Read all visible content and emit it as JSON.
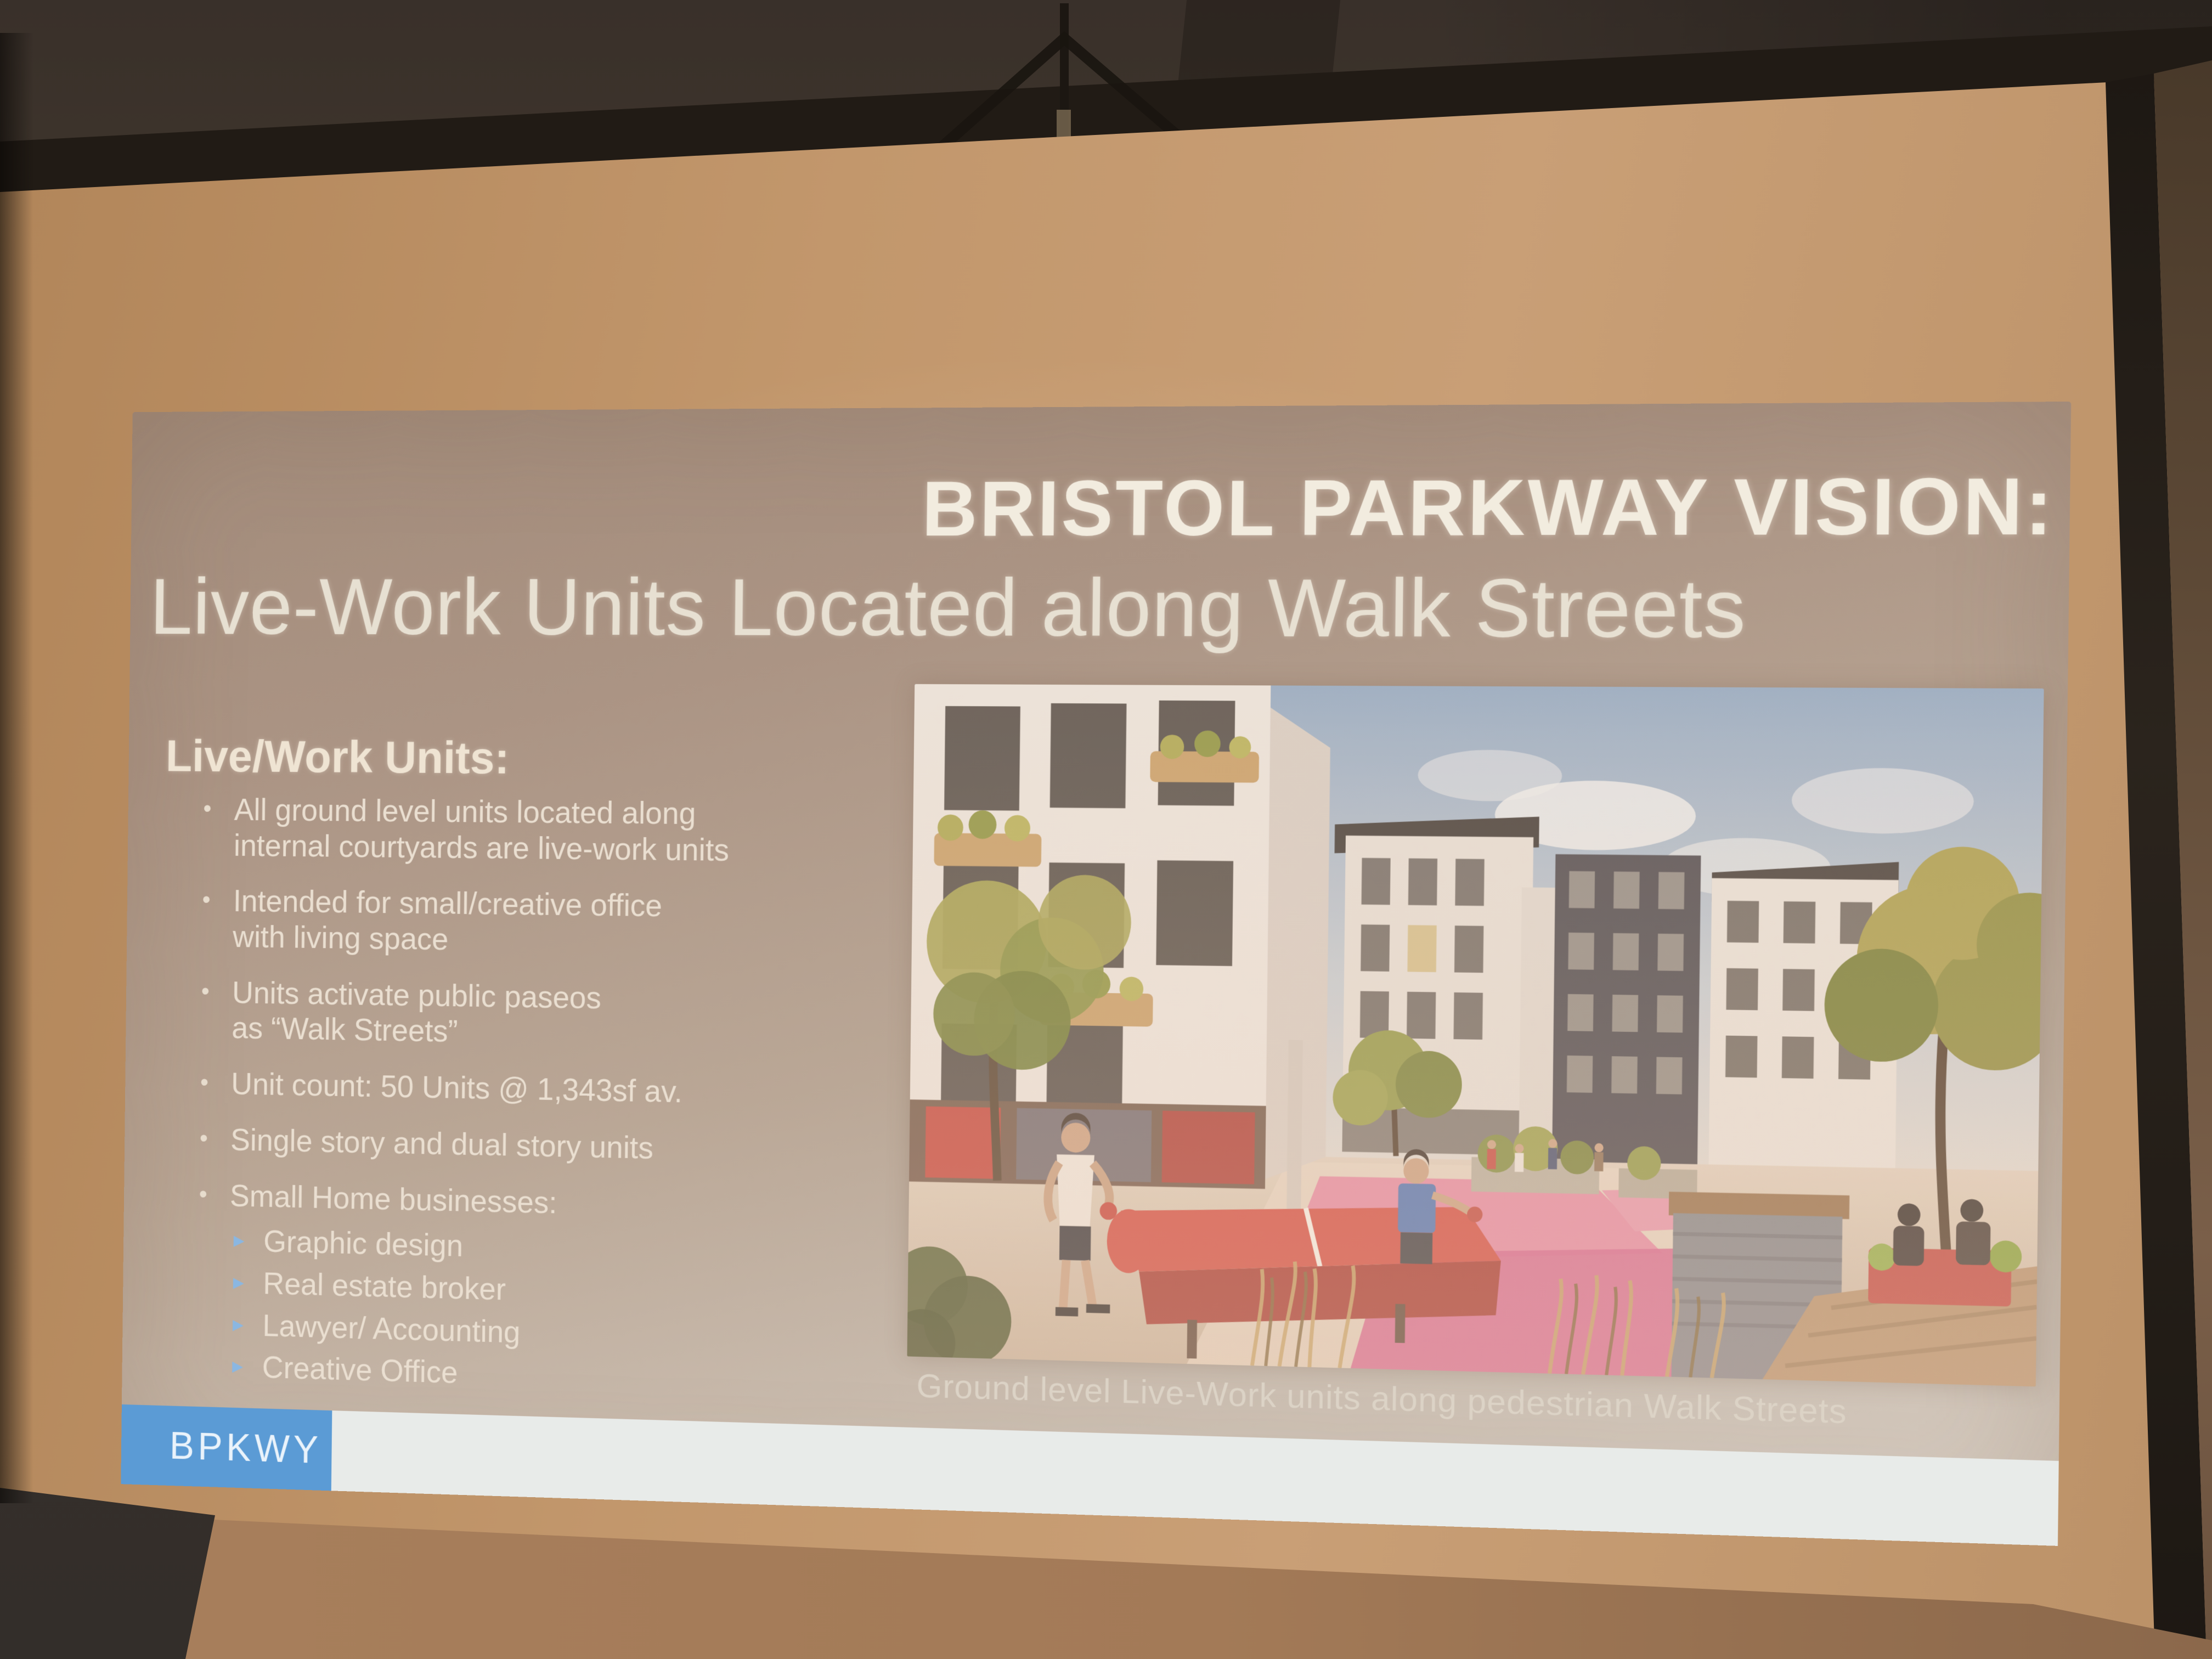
{
  "slide": {
    "title_line1": "BRISTOL PARKWAY VISION:",
    "title_line2": "Live-Work Units Located along Walk Streets",
    "left_column": {
      "heading": "Live/Work Units:",
      "bullet_glyph": "•",
      "sub_bullet_glyph": "▸",
      "bullets": [
        {
          "text": "All ground level units located along\ninternal courtyards are live-work units"
        },
        {
          "text": "Intended for small/creative office\nwith living space"
        },
        {
          "text": "Units activate public paseos\nas “Walk Streets”"
        },
        {
          "text": "Unit count: 50 Units @ 1,343sf av."
        },
        {
          "text": "Single story and dual story units"
        },
        {
          "text": "Small Home businesses:"
        }
      ],
      "sub_bullets": [
        {
          "text": "Graphic design"
        },
        {
          "text": "Real estate broker"
        },
        {
          "text": "Lawyer/ Accounting"
        },
        {
          "text": "Creative Office"
        }
      ]
    },
    "image_caption": "Ground level Live-Work units along pedestrian Walk Streets",
    "footer": {
      "label": "BPKWY"
    },
    "colors": {
      "footer_accent_blue": "#5b9bd5",
      "footer_bar_white": "#e8ebe9",
      "slide_background_tint": "#b5a090",
      "title_text": "#f2ecdf",
      "body_text": "#eadfd1",
      "sub_bullet_arrow_blue": "#8ab7e2",
      "projection_screen_tan": "#c2976c",
      "room_ceiling_brown": "#3a312a"
    }
  }
}
